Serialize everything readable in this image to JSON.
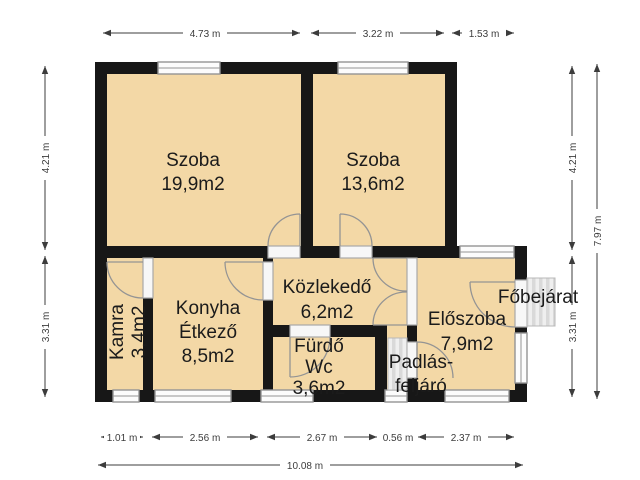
{
  "plan": {
    "rooms": [
      {
        "id": "szoba-1",
        "lines": [
          "Szoba",
          "19,9m2"
        ]
      },
      {
        "id": "szoba-2",
        "lines": [
          "Szoba",
          "13,6m2"
        ]
      },
      {
        "id": "kozlekedo",
        "lines": [
          "Közlekedő",
          "6,2m2"
        ]
      },
      {
        "id": "konyha-etkezo",
        "lines": [
          "Konyha",
          "Étkező",
          "8,5m2"
        ]
      },
      {
        "id": "kamra",
        "lines": [
          "Kamra",
          "3,4m2"
        ]
      },
      {
        "id": "furdo-wc",
        "lines": [
          "Fürdő",
          "Wc",
          "3,6m2"
        ]
      },
      {
        "id": "eloszoba",
        "lines": [
          "Előszoba",
          "7,9m2"
        ]
      },
      {
        "id": "padlas-feljaro",
        "lines": [
          "Padlás-",
          "feljáró"
        ]
      },
      {
        "id": "fobejarat",
        "lines": [
          "Főbejárat"
        ]
      }
    ],
    "dimensions": {
      "top": [
        "4.73 m",
        "3.22 m",
        "1.53 m"
      ],
      "left": [
        "4.21 m",
        "3.31 m"
      ],
      "right": [
        "4.21 m",
        "3.31 m"
      ],
      "right_total": "7.97 m",
      "bottom": [
        "1.01 m",
        "2.56 m",
        "2.67 m",
        "0.56 m",
        "2.37 m"
      ],
      "bottom_total": "10.08 m"
    },
    "colors": {
      "floor": "#f3d8a6",
      "wall": "#171717",
      "dimension": "#3c3c3c",
      "door_window": "#949494"
    }
  }
}
